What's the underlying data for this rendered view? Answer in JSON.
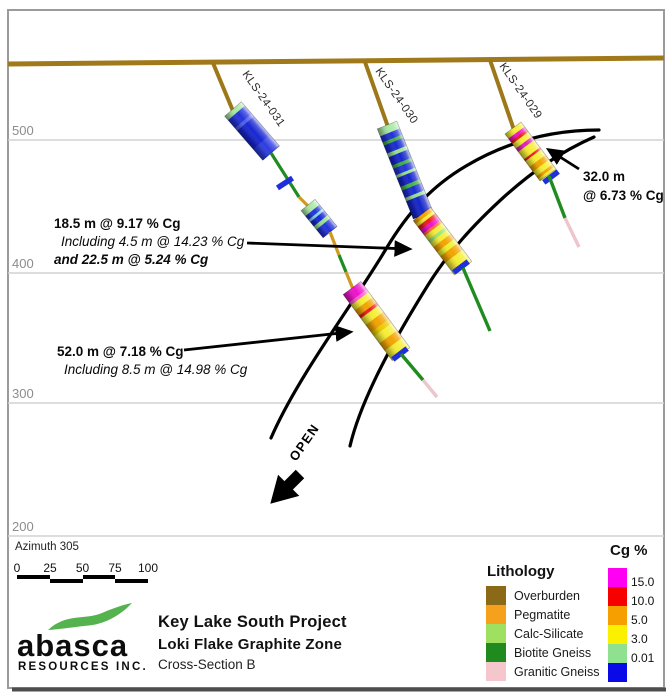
{
  "frame": {
    "x": 8,
    "y": 10,
    "w": 656,
    "h": 678
  },
  "surface": {
    "x1": 8,
    "y1": 64,
    "x2": 664,
    "y2": 58,
    "c": "#a07a1a",
    "w": 5
  },
  "gridlines": [
    {
      "label": "500",
      "y": 140
    },
    {
      "label": "400",
      "y": 273
    },
    {
      "label": "300",
      "y": 403
    },
    {
      "label": "200",
      "y": 536
    }
  ],
  "holes": [
    {
      "name": "KLS-24-031",
      "label": {
        "x": 242,
        "y": 74,
        "angle": 55
      },
      "segments": [
        {
          "t": "line",
          "x1": 213,
          "y1": 63,
          "x2": 233,
          "y2": 111,
          "c": "#9c7818",
          "w": 4
        },
        {
          "t": "cyl",
          "x1": 233,
          "y1": 109,
          "x2": 271,
          "y2": 153,
          "r": 11,
          "bands": [
            [
              "#a9e8a4",
              0.09
            ],
            [
              "#2333dc",
              0.18
            ],
            [
              "#4f5eec",
              0.06
            ],
            [
              "#1726d2",
              0.42
            ],
            [
              "#2d3ce2",
              0.25
            ]
          ]
        },
        {
          "t": "line",
          "x1": 271,
          "y1": 153,
          "x2": 299,
          "y2": 197,
          "c": "#1e8c1e",
          "w": 3.2
        },
        {
          "t": "tick",
          "x": 285,
          "y": 183,
          "a": 57
        },
        {
          "t": "line",
          "x1": 299,
          "y1": 197,
          "x2": 308,
          "y2": 206,
          "c": "#cf9a1f",
          "w": 3.2
        },
        {
          "t": "cyl",
          "x1": 308,
          "y1": 205,
          "x2": 330,
          "y2": 232,
          "r": 9,
          "bands": [
            [
              "#a9e8a4",
              0.2
            ],
            [
              "#2333dc",
              0.14
            ],
            [
              "#7fd3ee",
              0.08
            ],
            [
              "#1726d2",
              0.16
            ],
            [
              "#96df92",
              0.12
            ],
            [
              "#2333dc",
              0.3
            ]
          ]
        },
        {
          "t": "line",
          "x1": 330,
          "y1": 232,
          "x2": 339,
          "y2": 255,
          "c": "#cf9a1f",
          "w": 3.2
        },
        {
          "t": "line",
          "x1": 339,
          "y1": 255,
          "x2": 346,
          "y2": 272,
          "c": "#1e8c1e",
          "w": 3.2
        },
        {
          "t": "line",
          "x1": 346,
          "y1": 272,
          "x2": 353,
          "y2": 289,
          "c": "#cf9a1f",
          "w": 3.2
        },
        {
          "t": "tick",
          "x": 355,
          "y": 290,
          "a": 53
        },
        {
          "t": "cyl",
          "x1": 352,
          "y1": 288,
          "x2": 401,
          "y2": 354,
          "r": 11,
          "bands": [
            [
              "#f011cc",
              0.12
            ],
            [
              "#ff5ad8",
              0.04
            ],
            [
              "#f6ee33",
              0.08
            ],
            [
              "#f3a300",
              0.08
            ],
            [
              "#ee1c1c",
              0.04
            ],
            [
              "#f6ee33",
              0.1
            ],
            [
              "#f3a300",
              0.11
            ],
            [
              "#eecb00",
              0.06
            ],
            [
              "#f6ee33",
              0.11
            ],
            [
              "#f3a300",
              0.11
            ],
            [
              "#f6ee33",
              0.15
            ]
          ]
        },
        {
          "t": "tick",
          "x": 400,
          "y": 354,
          "a": 53
        },
        {
          "t": "line",
          "x1": 401,
          "y1": 354,
          "x2": 423,
          "y2": 380,
          "c": "#1e8c1e",
          "w": 3.4
        },
        {
          "t": "line",
          "x1": 423,
          "y1": 380,
          "x2": 437,
          "y2": 397,
          "c": "#ecc6cc",
          "w": 3.4
        }
      ]
    },
    {
      "name": "KLS-24-030",
      "label": {
        "x": 375,
        "y": 71,
        "angle": 55
      },
      "segments": [
        {
          "t": "line",
          "x1": 365,
          "y1": 62,
          "x2": 388,
          "y2": 127,
          "c": "#9c7818",
          "w": 4
        },
        {
          "t": "cyl",
          "x1": 387,
          "y1": 125,
          "x2": 423,
          "y2": 215,
          "r": 10.5,
          "bands": [
            [
              "#a9e8a4",
              0.08
            ],
            [
              "#2130d6",
              0.065
            ],
            [
              "#3fae45",
              0.035
            ],
            [
              "#1b2ad2",
              0.085
            ],
            [
              "#96df92",
              0.04
            ],
            [
              "#1626cc",
              0.09
            ],
            [
              "#3fae45",
              0.035
            ],
            [
              "#2333dc",
              0.07
            ],
            [
              "#96df92",
              0.03
            ],
            [
              "#1525ca",
              0.095
            ],
            [
              "#44b246",
              0.04
            ],
            [
              "#1b2cd2",
              0.08
            ],
            [
              "#96df92",
              0.035
            ],
            [
              "#1424c8",
              0.19
            ]
          ]
        },
        {
          "t": "cyl",
          "x1": 422,
          "y1": 214,
          "x2": 463,
          "y2": 268,
          "r": 11,
          "bands": [
            [
              "#f3a300",
              0.06
            ],
            [
              "#f6ee33",
              0.05
            ],
            [
              "#ee1c1c",
              0.06
            ],
            [
              "#f011cc",
              0.07
            ],
            [
              "#ff6a3a",
              0.04
            ],
            [
              "#f6ee33",
              0.08
            ],
            [
              "#9be577",
              0.05
            ],
            [
              "#f6ee33",
              0.08
            ],
            [
              "#f3a300",
              0.09
            ],
            [
              "#eef02a",
              0.08
            ],
            [
              "#f3a300",
              0.12
            ],
            [
              "#f6ee33",
              0.22
            ]
          ]
        },
        {
          "t": "tick",
          "x": 461,
          "y": 267,
          "a": 53
        },
        {
          "t": "line",
          "x1": 463,
          "y1": 268,
          "x2": 490,
          "y2": 331,
          "c": "#1e8c1e",
          "w": 3.4
        }
      ]
    },
    {
      "name": "KLS-24-029",
      "label": {
        "x": 499,
        "y": 66,
        "angle": 55
      },
      "segments": [
        {
          "t": "line",
          "x1": 490,
          "y1": 60,
          "x2": 514,
          "y2": 130,
          "c": "#9c7818",
          "w": 4
        },
        {
          "t": "cyl",
          "x1": 513,
          "y1": 128,
          "x2": 548,
          "y2": 175,
          "r": 10,
          "bands": [
            [
              "#f6ee33",
              0.1
            ],
            [
              "#f011cc",
              0.06
            ],
            [
              "#ee1c1c",
              0.05
            ],
            [
              "#f6ee33",
              0.1
            ],
            [
              "#e020b4",
              0.07
            ],
            [
              "#f6ee33",
              0.16
            ],
            [
              "#ee1c1c",
              0.04
            ],
            [
              "#f6ee33",
              0.12
            ],
            [
              "#f3a300",
              0.1
            ],
            [
              "#f6ee33",
              0.1
            ],
            [
              "#f3a300",
              0.05
            ],
            [
              "#f6ee33",
              0.05
            ]
          ]
        },
        {
          "t": "tick",
          "x": 551,
          "y": 177,
          "a": 53
        },
        {
          "t": "line",
          "x1": 549,
          "y1": 176,
          "x2": 565,
          "y2": 218,
          "c": "#1e8c1e",
          "w": 3.4
        },
        {
          "t": "line",
          "x1": 565,
          "y1": 218,
          "x2": 579,
          "y2": 247,
          "c": "#ecc6cc",
          "w": 3.4
        }
      ]
    }
  ],
  "zone": {
    "upper": "M599,130 C552,130 508,141 466,166 C432,186 408,212 386,249 C352,306 298,376 271,438",
    "lower": "M594,137 C560,152 532,172 505,196 C472,226 448,253 428,285 C400,330 362,395 350,446",
    "open_label": "OPEN",
    "open_pos": {
      "x": 296,
      "y": 462,
      "angle": -55
    },
    "open_arrow": {
      "x": 300,
      "y": 474,
      "angle": 135
    }
  },
  "annotations": [
    {
      "lines": [
        {
          "text": "18.5 m @ 9.17 % Cg",
          "x": 54,
          "y": 228,
          "style": "b"
        },
        {
          "text": "Including 4.5 m @ 14.23 % Cg",
          "x": 61,
          "y": 246,
          "style": "i"
        },
        {
          "text": "and 22.5 m @ 5.24 % Cg",
          "x": 54,
          "y": 264,
          "style": "bi"
        }
      ],
      "arrow": {
        "x1": 247,
        "y1": 243,
        "x2": 409,
        "y2": 249
      }
    },
    {
      "lines": [
        {
          "text": "52.0 m @ 7.18 % Cg",
          "x": 57,
          "y": 356,
          "style": "b"
        },
        {
          "text": "Including 8.5 m @ 14.98 % Cg",
          "x": 64,
          "y": 374,
          "style": "i"
        }
      ],
      "arrow": {
        "x1": 184,
        "y1": 350,
        "x2": 350,
        "y2": 332
      }
    },
    {
      "lines": [
        {
          "text": "32.0 m",
          "x": 583,
          "y": 181,
          "style": "b"
        },
        {
          "text": "@ 6.73 % Cg",
          "x": 583,
          "y": 200,
          "style": "b"
        }
      ],
      "arrow": {
        "x1": 579,
        "y1": 169,
        "x2": 549,
        "y2": 150
      }
    }
  ],
  "footer": {
    "azimuth": "Azimuth 305",
    "scalebar": {
      "ticks": [
        "0",
        "25",
        "50",
        "75",
        "100"
      ],
      "centers": [
        17,
        50,
        82.5,
        115,
        148
      ],
      "bar_left": 17,
      "bar_top": 575,
      "seg_w": 32.75
    },
    "logo": {
      "name": "abasca",
      "sub": "RESOURCES INC.",
      "swoosh_color": "#55b34f"
    },
    "titles": {
      "line1": "Key Lake South Project",
      "line2": "Loki Flake Graphite Zone",
      "line3": "Cross-Section B"
    }
  },
  "legend": {
    "lithology": {
      "title": "Lithology",
      "items": [
        {
          "label": "Overburden",
          "color": "#8a6a16"
        },
        {
          "label": "Pegmatite",
          "color": "#f5a11d"
        },
        {
          "label": "Calc-Silicate",
          "color": "#a0e060"
        },
        {
          "label": "Biotite Gneiss",
          "color": "#1f8b1f"
        },
        {
          "label": "Granitic Gneiss",
          "color": "#f5c6cd"
        }
      ]
    },
    "cg": {
      "title": "Cg %",
      "colors": [
        "#ff00f2",
        "#f70000",
        "#f5a000",
        "#fbf000",
        "#8fe08f",
        "#0a0ae8"
      ],
      "labels": [
        "15.0",
        "10.0",
        "5.0",
        "3.0",
        "0.01"
      ]
    }
  }
}
